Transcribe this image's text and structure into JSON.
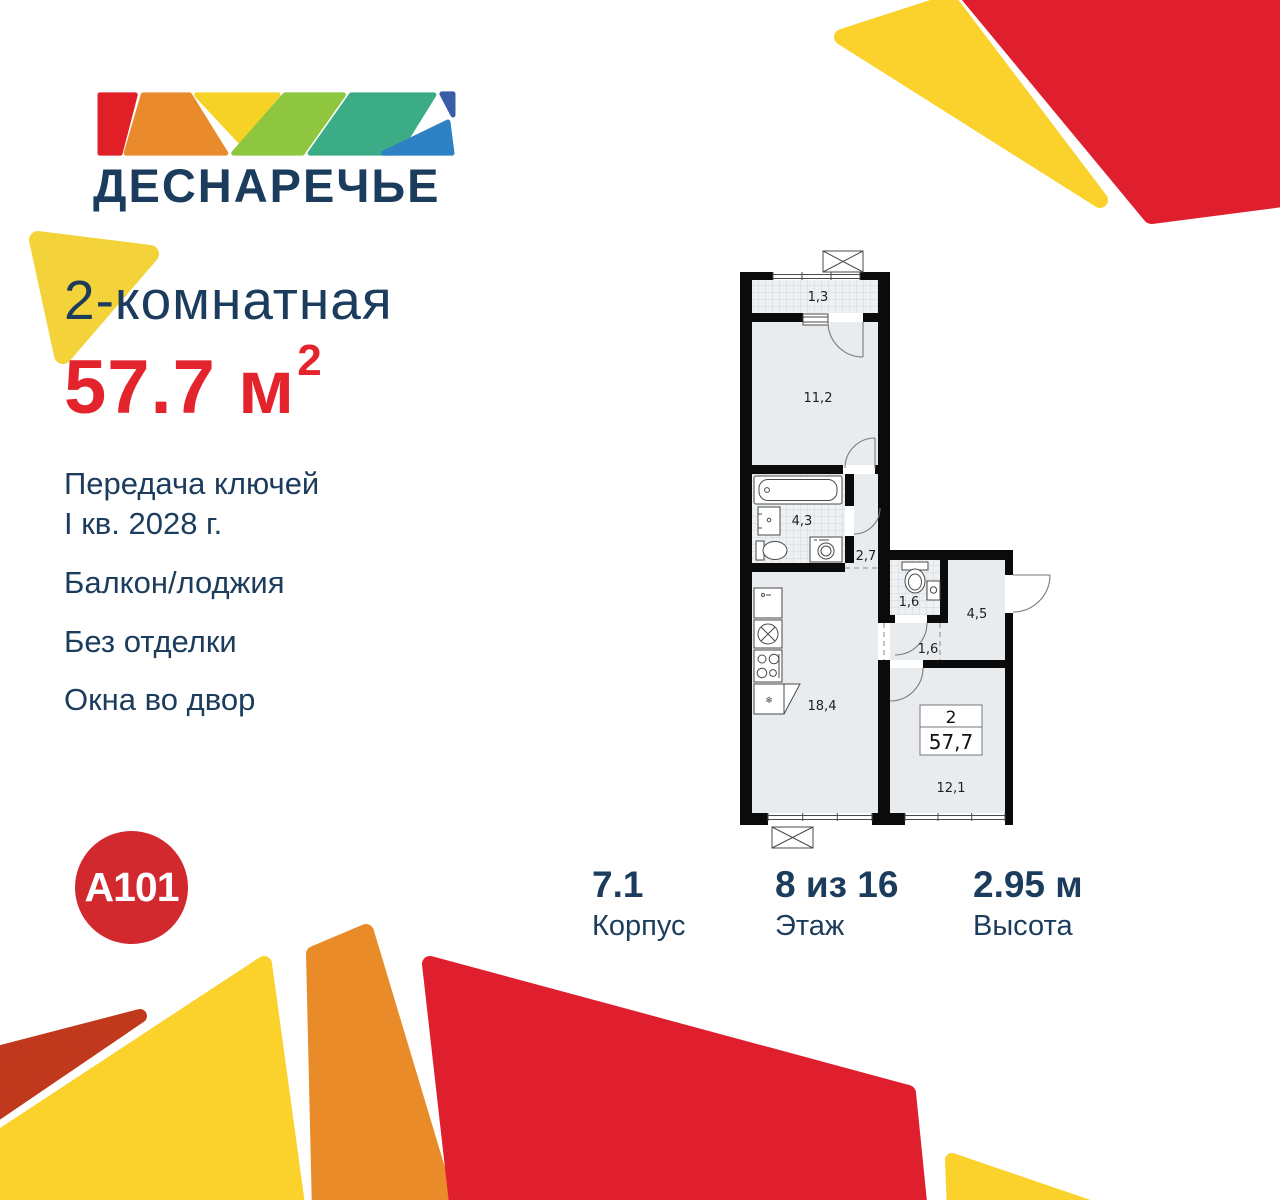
{
  "brand": {
    "logo_text": "ДЕСНАРЕЧЬЕ",
    "developer": "A101"
  },
  "listing": {
    "title": "2-комнатная",
    "area_value": "57.7 м",
    "area_sup": "2"
  },
  "features": {
    "handover_line1": "Передача ключей",
    "handover_line2": "I кв. 2028 г.",
    "balcony": "Балкон/лоджия",
    "finishing": "Без отделки",
    "windows": "Окна во двор"
  },
  "stats": {
    "building": {
      "value": "7.1",
      "label": "Корпус"
    },
    "floor": {
      "value": "8 из 16",
      "label": "Этаж"
    },
    "height": {
      "value": "2.95 м",
      "label": "Высота"
    }
  },
  "floorplan": {
    "tag": {
      "rooms": "2",
      "area": "57,7"
    },
    "labels": {
      "balcony": "1,3",
      "living_room": "11,2",
      "bathroom": "4,3",
      "hallway": "2,7",
      "wc": "1,6",
      "hallway2": "1,6",
      "entry": "4,5",
      "kitchen_living": "18,4",
      "bedroom": "12,1"
    }
  },
  "colors": {
    "navy": "#1b3c5c",
    "accent_red": "#e3242c",
    "shape_red": "#df1f2d",
    "shape_yellow": "#fbd22b",
    "shape_orange": "#e88b28",
    "shape_brick": "#c0391d",
    "logo_red": "#e01f26",
    "logo_orange": "#e98a2d",
    "logo_yellow": "#f7d226",
    "logo_green": "#8ec63f",
    "logo_teal": "#3bac86",
    "logo_blue_dark": "#3a5da7",
    "logo_blue_light": "#2e82c4",
    "a101_red": "#d2292e"
  }
}
